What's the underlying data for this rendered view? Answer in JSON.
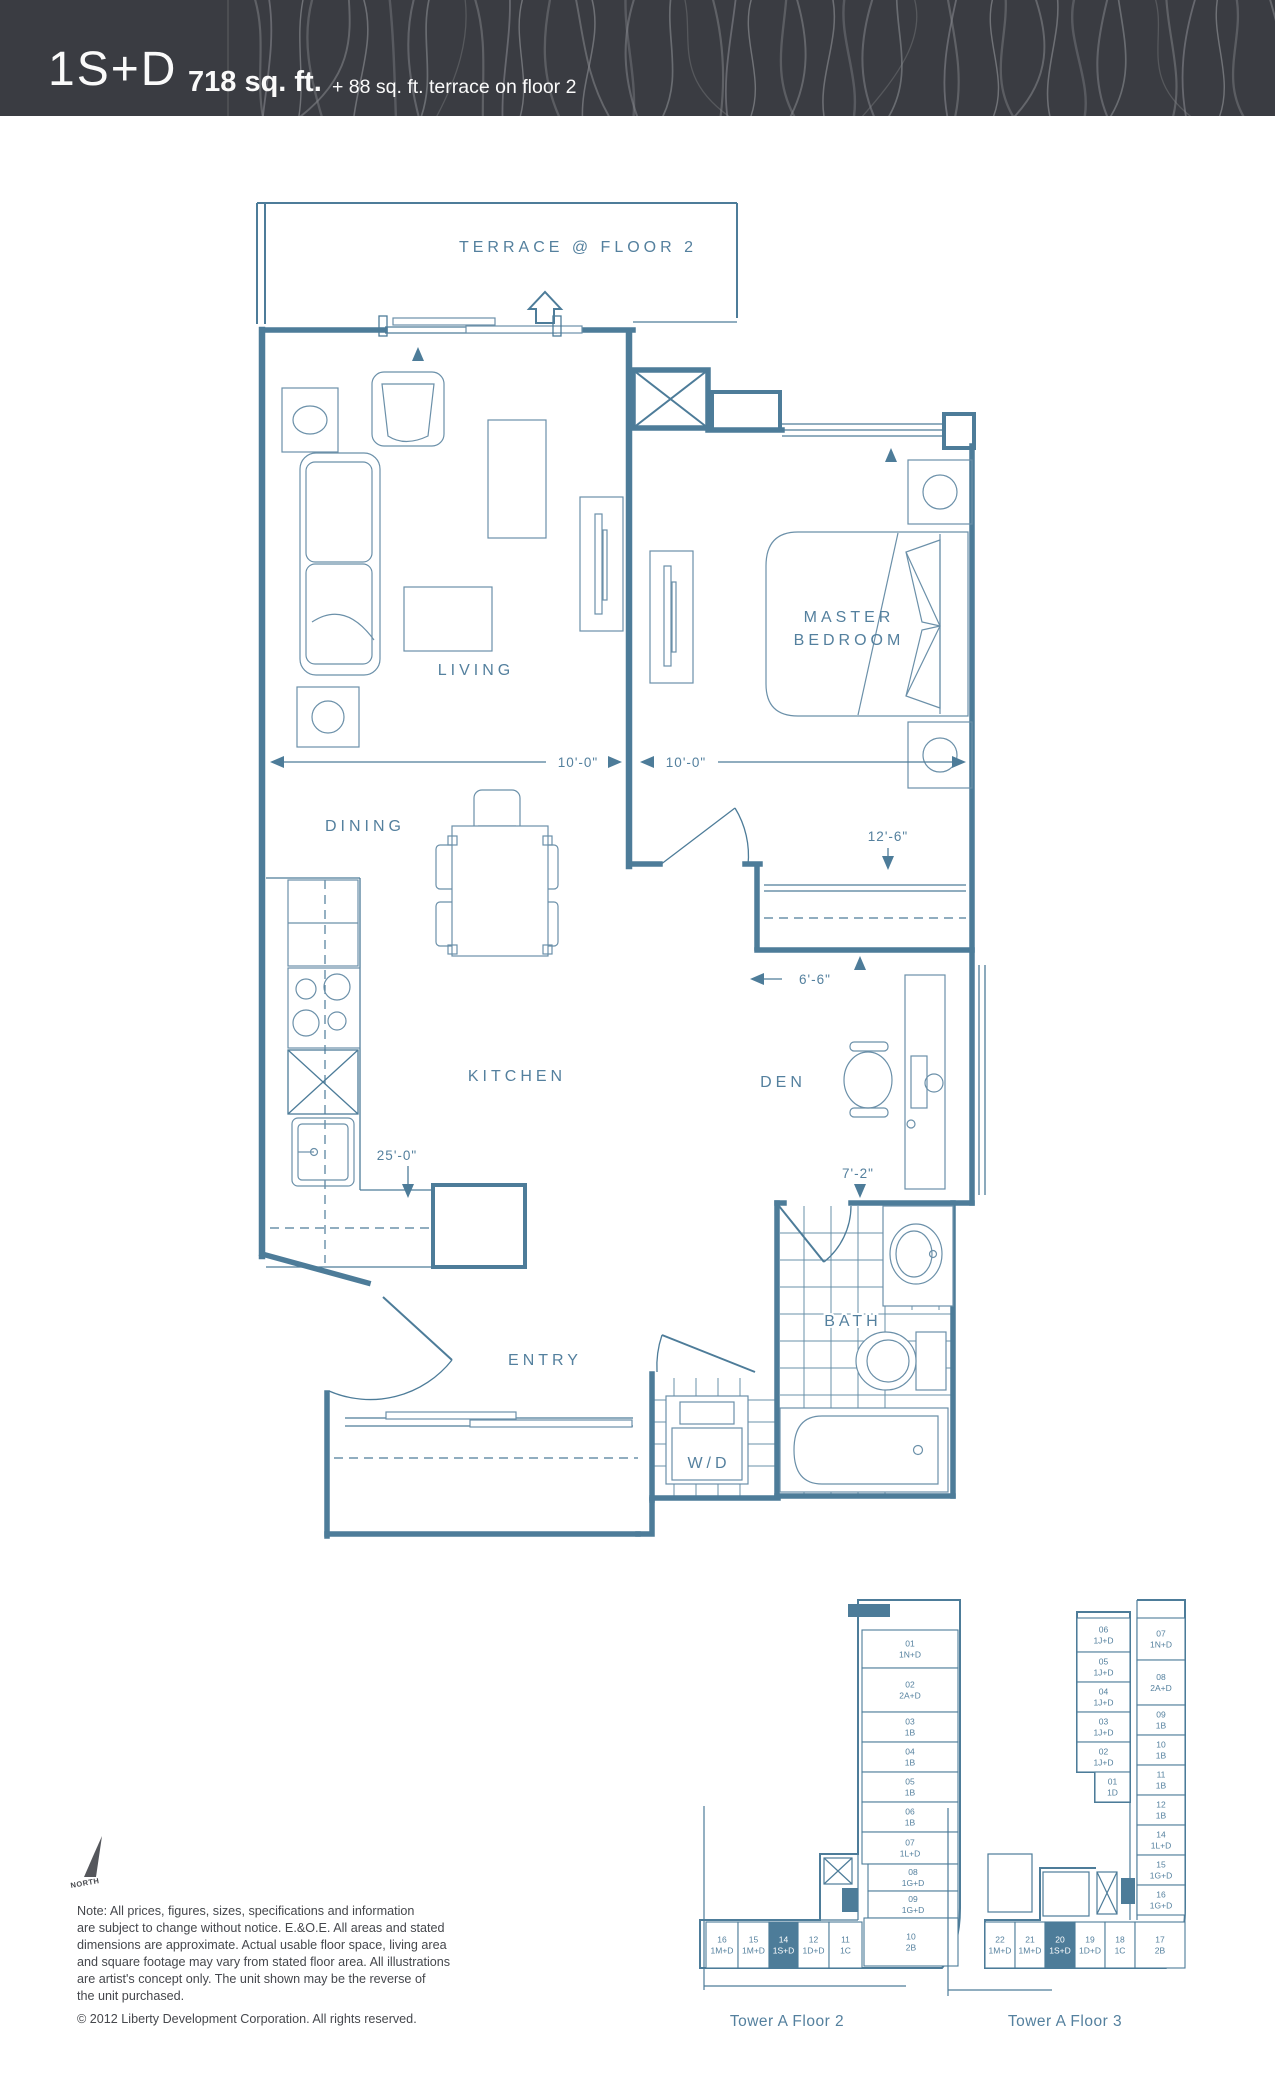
{
  "header": {
    "plan_name": "1S+D",
    "area": "718 sq. ft.",
    "area_suffix": "+ 88 sq. ft. terrace on floor 2"
  },
  "plan": {
    "labels": {
      "terrace": "TERRACE @ FLOOR 2",
      "living": "LIVING",
      "master1": "MASTER",
      "master2": "BEDROOM",
      "dining": "DINING",
      "kitchen": "KITCHEN",
      "den": "DEN",
      "entry": "ENTRY",
      "bath": "BATH",
      "wd": "W/D"
    },
    "dims": {
      "living_w": "10'-0\"",
      "bed_w": "10'-0\"",
      "closet": "12'-6\"",
      "den_w": "6'-6\"",
      "kitchen_run": "25'-0\"",
      "den_d": "7'-2\""
    }
  },
  "colors": {
    "line": "#4d7c99",
    "label": "#54809e",
    "header_bg": "#3a3c42",
    "header_stripes": "#83858a",
    "highlight": "#4d7c99"
  },
  "north_label": "NORTH",
  "notes": {
    "lines": [
      "Note: All prices, figures, sizes, specifications and information",
      "are subject to change without notice. E.&O.E. All areas and stated",
      "dimensions are approximate. Actual usable floor space, living area",
      "and square footage may vary from stated floor area. All illustrations",
      "are artist's concept only. The unit shown may be the reverse of",
      "the unit purchased."
    ],
    "copyright": "© 2012 Liberty Development Corporation. All rights reserved."
  },
  "keyplans": [
    {
      "caption": "Tower A Floor 2",
      "units": [
        {
          "no": "01",
          "type": "1N+D"
        },
        {
          "no": "02",
          "type": "2A+D"
        },
        {
          "no": "03",
          "type": "1B"
        },
        {
          "no": "04",
          "type": "1B"
        },
        {
          "no": "05",
          "type": "1B"
        },
        {
          "no": "06",
          "type": "1B"
        },
        {
          "no": "07",
          "type": "1L+D"
        },
        {
          "no": "08",
          "type": "1G+D"
        },
        {
          "no": "09",
          "type": "1G+D"
        },
        {
          "no": "10",
          "type": "2B"
        },
        {
          "no": "16",
          "type": "1M+D"
        },
        {
          "no": "15",
          "type": "1M+D"
        },
        {
          "no": "14",
          "type": "1S+D",
          "highlight": true
        },
        {
          "no": "12",
          "type": "1D+D"
        },
        {
          "no": "11",
          "type": "1C"
        }
      ]
    },
    {
      "caption": "Tower A Floor 3",
      "units": [
        {
          "no": "06",
          "type": "1J+D"
        },
        {
          "no": "05",
          "type": "1J+D"
        },
        {
          "no": "04",
          "type": "1J+D"
        },
        {
          "no": "03",
          "type": "1J+D"
        },
        {
          "no": "02",
          "type": "1J+D"
        },
        {
          "no": "01",
          "type": "1D"
        },
        {
          "no": "07",
          "type": "1N+D"
        },
        {
          "no": "08",
          "type": "2A+D"
        },
        {
          "no": "09",
          "type": "1B"
        },
        {
          "no": "10",
          "type": "1B"
        },
        {
          "no": "11",
          "type": "1B"
        },
        {
          "no": "12",
          "type": "1B"
        },
        {
          "no": "14",
          "type": "1L+D"
        },
        {
          "no": "15",
          "type": "1G+D"
        },
        {
          "no": "16",
          "type": "1G+D"
        },
        {
          "no": "22",
          "type": "1M+D"
        },
        {
          "no": "21",
          "type": "1M+D"
        },
        {
          "no": "20",
          "type": "1S+D",
          "highlight": true
        },
        {
          "no": "19",
          "type": "1D+D"
        },
        {
          "no": "18",
          "type": "1C"
        },
        {
          "no": "17",
          "type": "2B"
        }
      ]
    }
  ]
}
